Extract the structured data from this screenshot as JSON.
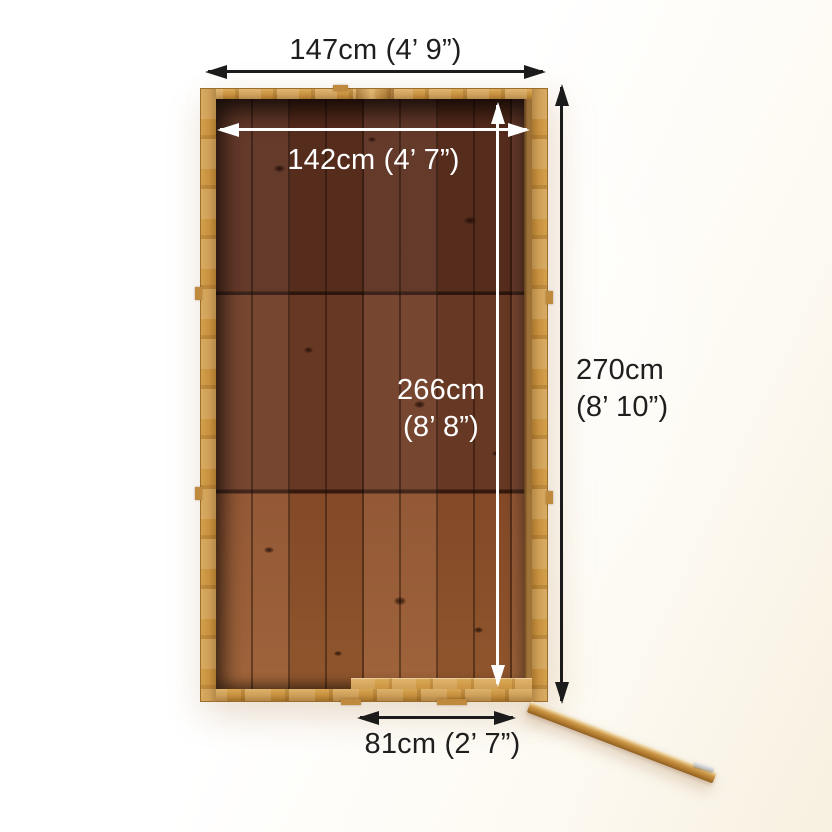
{
  "colors": {
    "background": "#fdfaf2",
    "arrow_dark": "#1b1b1b",
    "arrow_light": "#ffffff",
    "text_dark": "#1e1e1e",
    "text_light": "#ffffff",
    "frame_wood": "#c7913f",
    "floor_top": "#5c2f1f",
    "floor_middle": "#6f3c26",
    "floor_bottom": "#8d4f2b",
    "door_wood": "#c08a3e"
  },
  "dimensions": {
    "outer_width": {
      "label": "147cm (4’ 9”)"
    },
    "inner_width": {
      "label": "142cm (4’ 7”)"
    },
    "outer_depth": {
      "line1": "270cm",
      "line2": "(8’ 10”)"
    },
    "inner_depth": {
      "line1": "266cm",
      "line2": "(8’ 8”)"
    },
    "door_width": {
      "label": "81cm (2’ 7”)"
    }
  }
}
